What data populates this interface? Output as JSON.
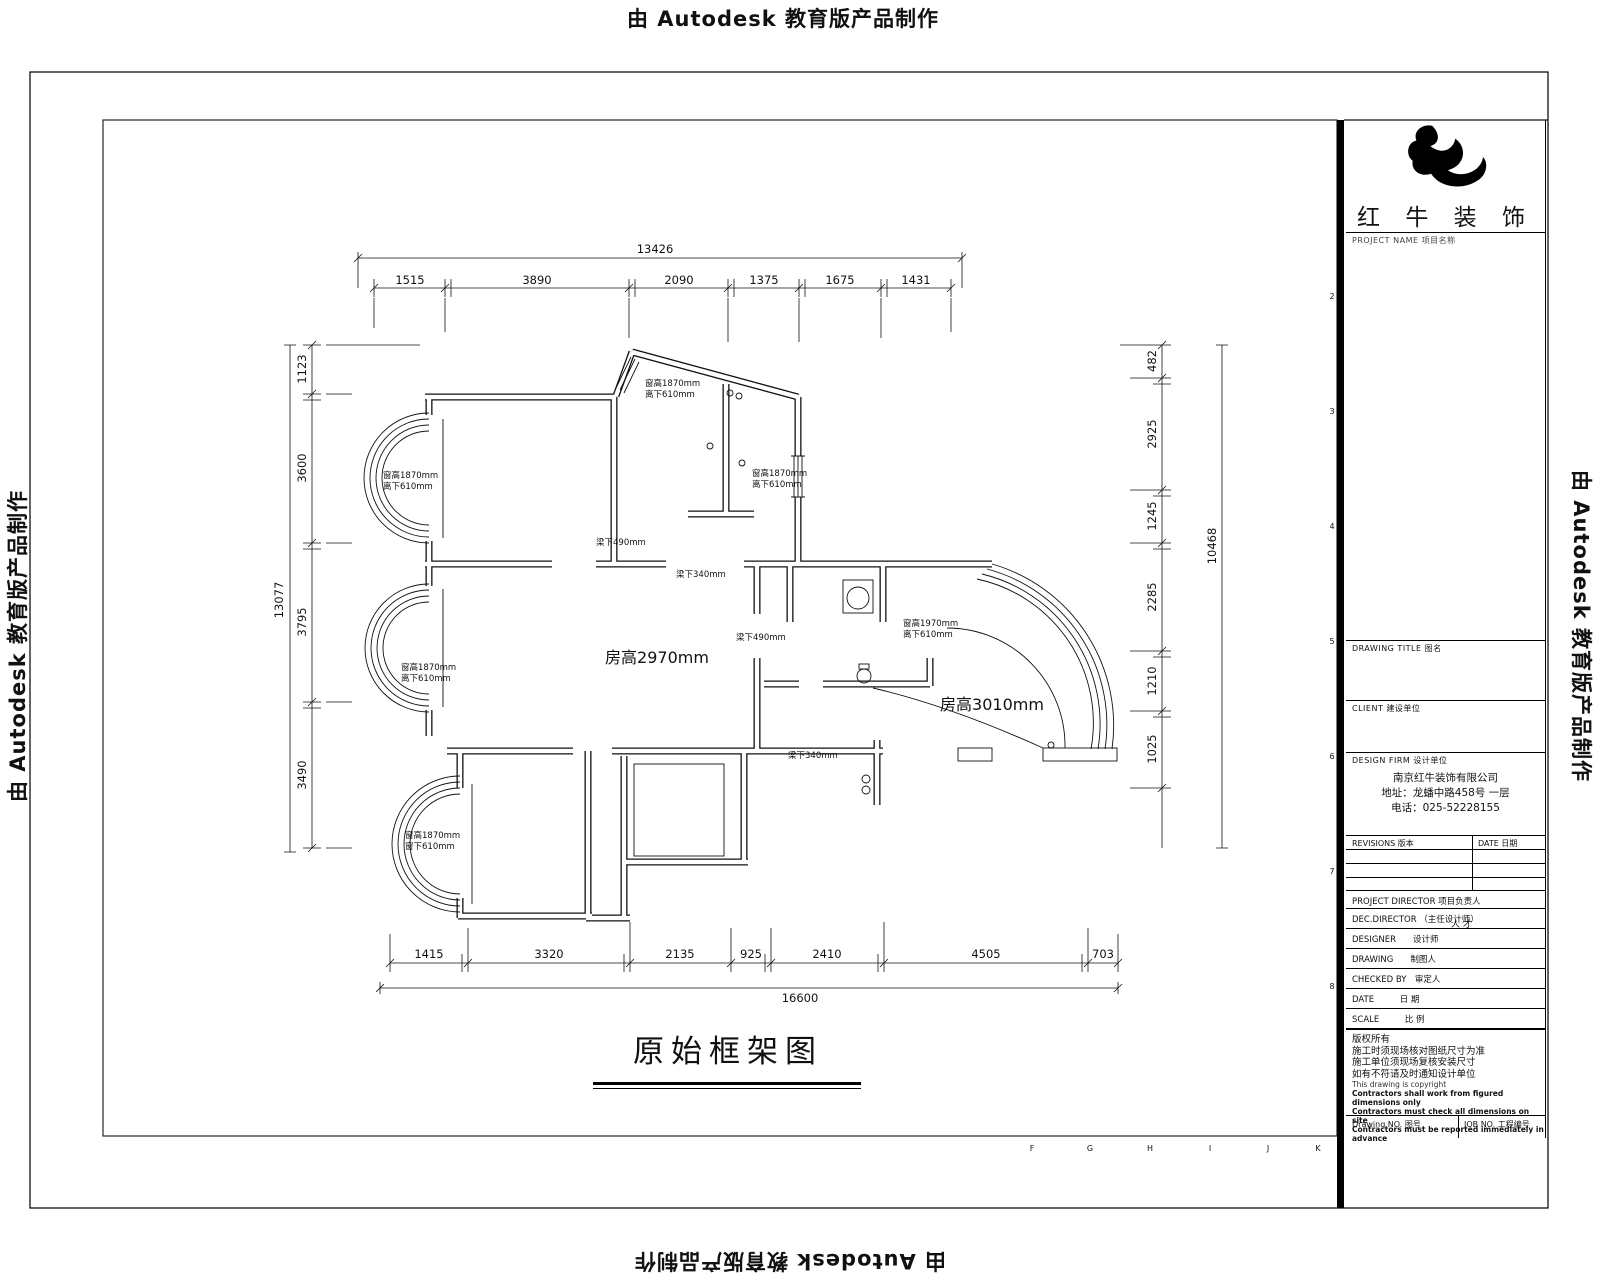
{
  "edition_notice": "由 Autodesk 教育版产品制作",
  "grid": {
    "letters": [
      "F",
      "G",
      "H",
      "I",
      "J",
      "K"
    ],
    "numbers": [
      "2",
      "3",
      "4",
      "5",
      "6",
      "7",
      "8"
    ]
  },
  "plan": {
    "title": "原始框架图",
    "labels": {
      "living_height": "房高2970mm",
      "balcony_height": "房高3010mm"
    },
    "window": {
      "h1870": "窗高1870mm",
      "h1970": "窗高1970mm",
      "off610": "离下610mm",
      "off610b": "窗下610mm"
    },
    "beam": {
      "b490": "梁下490mm",
      "b340": "梁下340mm"
    },
    "dims": {
      "top": {
        "total": "13426",
        "segs": [
          "1515",
          "3890",
          "2090",
          "1375",
          "1675",
          "1431"
        ]
      },
      "bottom": {
        "total": "16600",
        "segs": [
          "1415",
          "3320",
          "2135",
          "925",
          "2410",
          "4505",
          "703"
        ]
      },
      "left": {
        "total": "13077",
        "segs": [
          "1123",
          "3600",
          "3795",
          "3490"
        ]
      },
      "right": {
        "total": "10468",
        "segs": [
          "482",
          "2925",
          "1245",
          "2285",
          "1210",
          "1025"
        ]
      }
    }
  },
  "title_block": {
    "brand": "红 牛 装 饰",
    "project_label": "PROJECT NAME  项目名称",
    "drawing_title_label": "DRAWING TITLE  图名",
    "client_label": "CLIENT  建设单位",
    "design_firm_label": "DESIGN FIRM  设计单位",
    "firm": {
      "name": "南京红牛装饰有限公司",
      "address": "地址：龙蟠中路458号 一层",
      "phone": "电话：025-52228155"
    },
    "rev_header": {
      "rev": "REVISIONS 版本",
      "date": "DATE  日期"
    },
    "rows": [
      {
        "label": "PROJECT DIRECTOR  项目负责人",
        "value": ""
      },
      {
        "label": "DEC.DIRECTOR （主任设计师）",
        "value": "人  才"
      },
      {
        "label": "DESIGNER　　设计师",
        "value": ""
      },
      {
        "label": "DRAWING　　制图人",
        "value": ""
      },
      {
        "label": "CHECKED BY　审定人",
        "value": ""
      },
      {
        "label": "DATE　　　日  期",
        "value": ""
      },
      {
        "label": "SCALE　　　比  例",
        "value": ""
      }
    ],
    "notes_cn": [
      "版权所有",
      "施工时须现场核对图纸尺寸为准",
      "施工单位须现场复核安装尺寸",
      "如有不符请及时通知设计单位"
    ],
    "notes_en": [
      "This drawing is copyright",
      "Contractors shall work from figured dimensions only",
      "Contractors must check all dimensions on site",
      "Contractors must be reported immediately in advance"
    ],
    "drawing_no_label": "Drawing NO.  图号",
    "job_no_label": "JOB NO.  工程编号"
  }
}
